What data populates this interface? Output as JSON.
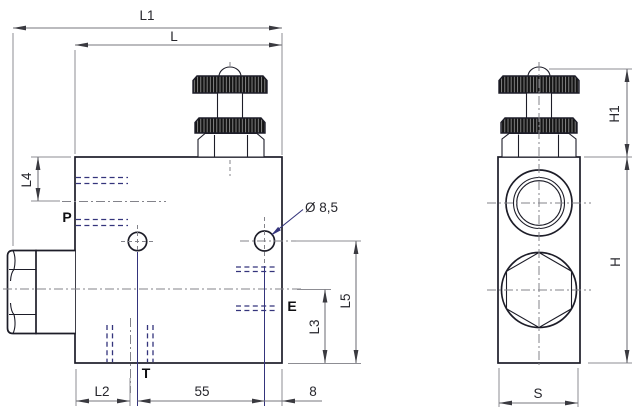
{
  "drawing": {
    "labels": {
      "l1": "L1",
      "l": "L",
      "l4": "L4",
      "p": "P",
      "dia": "Ø 8,5",
      "e": "E",
      "l5": "L5",
      "l3": "L3",
      "l2": "L2",
      "t": "T",
      "d55": "55",
      "d8": "8",
      "h1": "H1",
      "h": "H",
      "s": "S"
    },
    "colors": {
      "background": "#ffffff",
      "outline": "#1d1d28",
      "hidden_line": "#34347c",
      "dimension_line": "#77777d",
      "arrow": "#3a3a40",
      "extension_line": "#8d8d93",
      "centerline": "#83838a",
      "label_text": "#26262c",
      "port_text": "#0f0f12",
      "knurl_fill": "#141414"
    }
  }
}
